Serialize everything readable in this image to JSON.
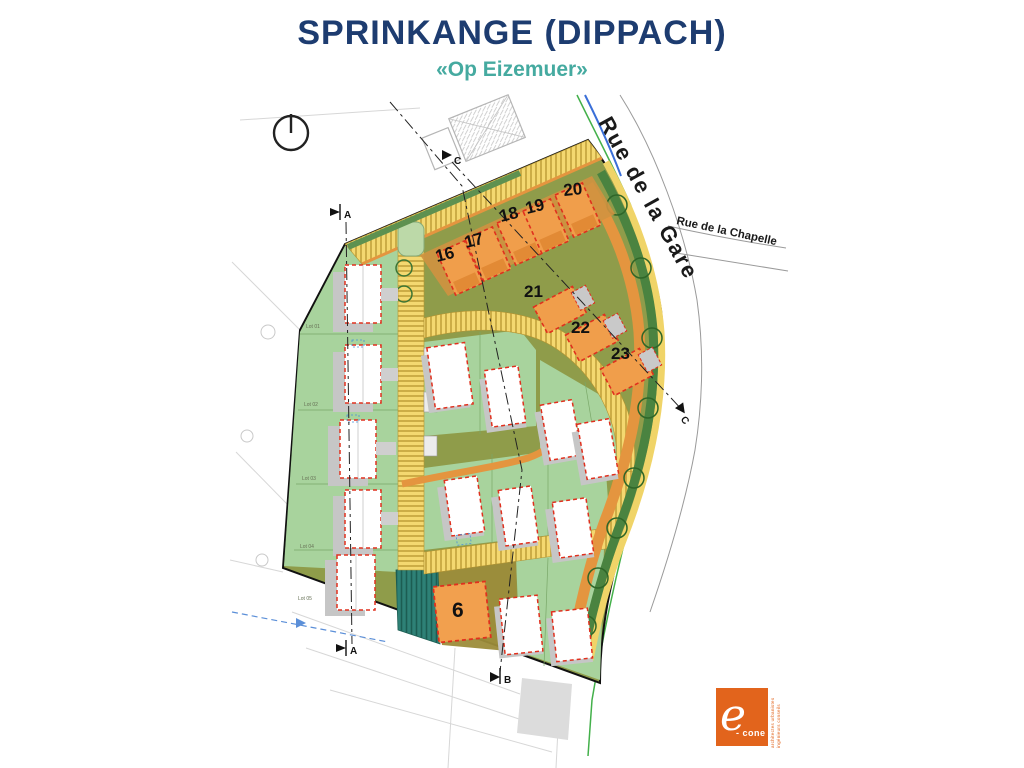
{
  "title": "SPRINKANGE (DIPPACH)",
  "subtitle": "«Op Eizemuer»",
  "streets": {
    "rue_de_la_gare": "Rue de la Gare",
    "rue_de_la_chapelle": "Rue de la Chapelle"
  },
  "lots": {
    "top_row": [
      "16",
      "17",
      "18",
      "19",
      "20"
    ],
    "diagonal_row": [
      "21",
      "22",
      "23"
    ],
    "detached": [
      "6"
    ]
  },
  "lot_labels": [
    "Lot 01",
    "Lot 02",
    "Lot 03",
    "Lot 04",
    "Lot 05"
  ],
  "section_markers": {
    "a": "A",
    "b": "B",
    "c": "C"
  },
  "logo": {
    "glyph": "e",
    "name": "- cone",
    "tagline_line1": "architectes urbanistes",
    "tagline_line2": "ingénieurs conseils"
  },
  "colors": {
    "title_navy": "#1d3c70",
    "subtitle_teal": "#45aaa0",
    "site_olive": "#8f9c4a",
    "lot_green": "#a8d39d",
    "road_yellow": "#f4d870",
    "building_orange": "#f09e4b",
    "path_orange": "#e4953f",
    "hedge_green": "#47823b",
    "basin_teal": "#2e8176",
    "outline_red": "#e0301e"
  }
}
